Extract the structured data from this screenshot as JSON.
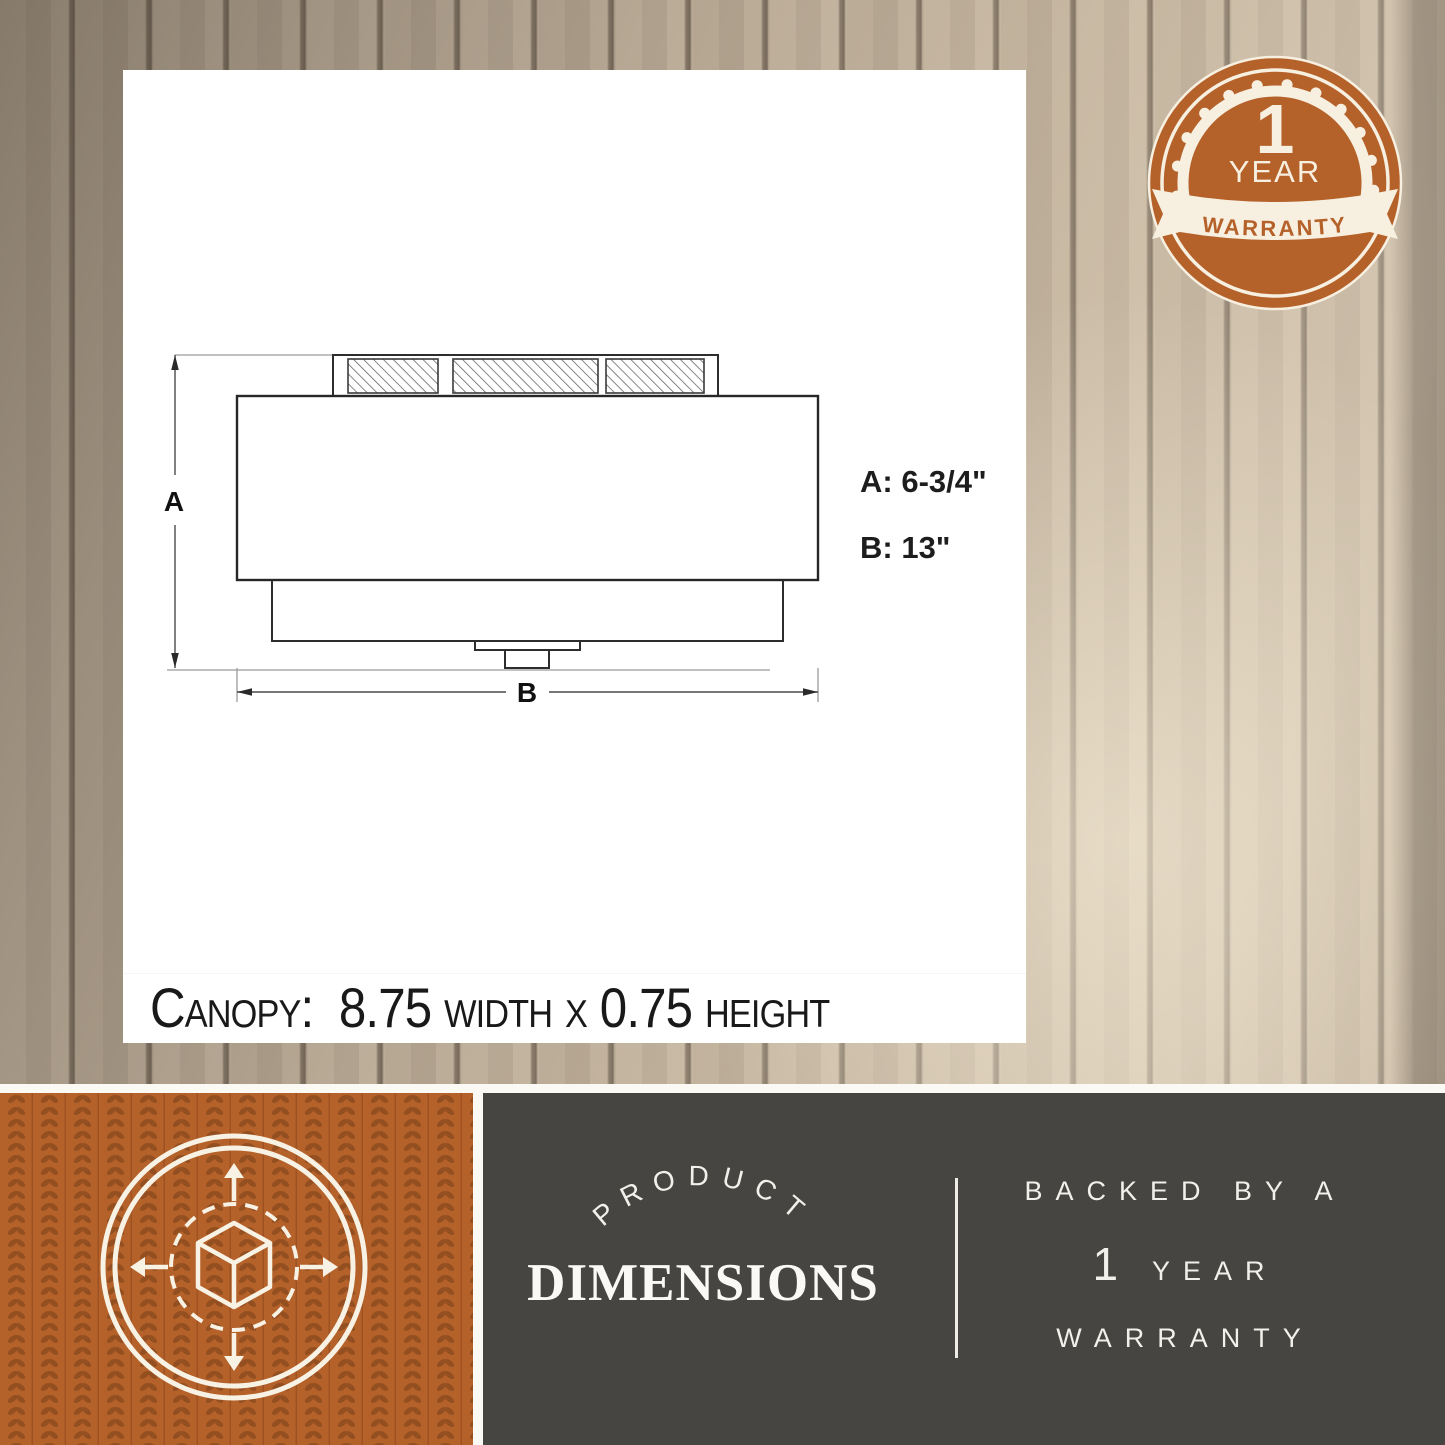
{
  "card": {
    "drawing": {
      "dim_a_label": "A",
      "dim_b_label": "B",
      "spec_a": "A: 6-3/4\"",
      "spec_b": "B: 13\""
    },
    "canopy_text": "Canopy:  8.75 width x 0.75 height"
  },
  "warranty_badge": {
    "number": "1",
    "year": "YEAR",
    "ribbon": "WARRANTY"
  },
  "bottom_bar": {
    "dimensions_panel": {
      "arched": "PRODUCT",
      "title": "DIMENSIONS"
    },
    "warranty_panel": {
      "line1": "BACKED BY A",
      "number": "1",
      "year": "YEAR",
      "line3": "WARRANTY"
    }
  },
  "colors": {
    "accent_orange": "#b5612a",
    "pattern_orange_dark": "#8e4c1e",
    "cream": "#f7efe0",
    "panel_gray": "#474542",
    "drawing_line": "#2a2a2a",
    "wood_light": "#e3d7c2",
    "wood_groove": "#6a5d4e"
  },
  "icons": {
    "warranty_badge": "rosette-seal-icon",
    "dimensions_tile": "cube-expand-arrows-icon"
  }
}
